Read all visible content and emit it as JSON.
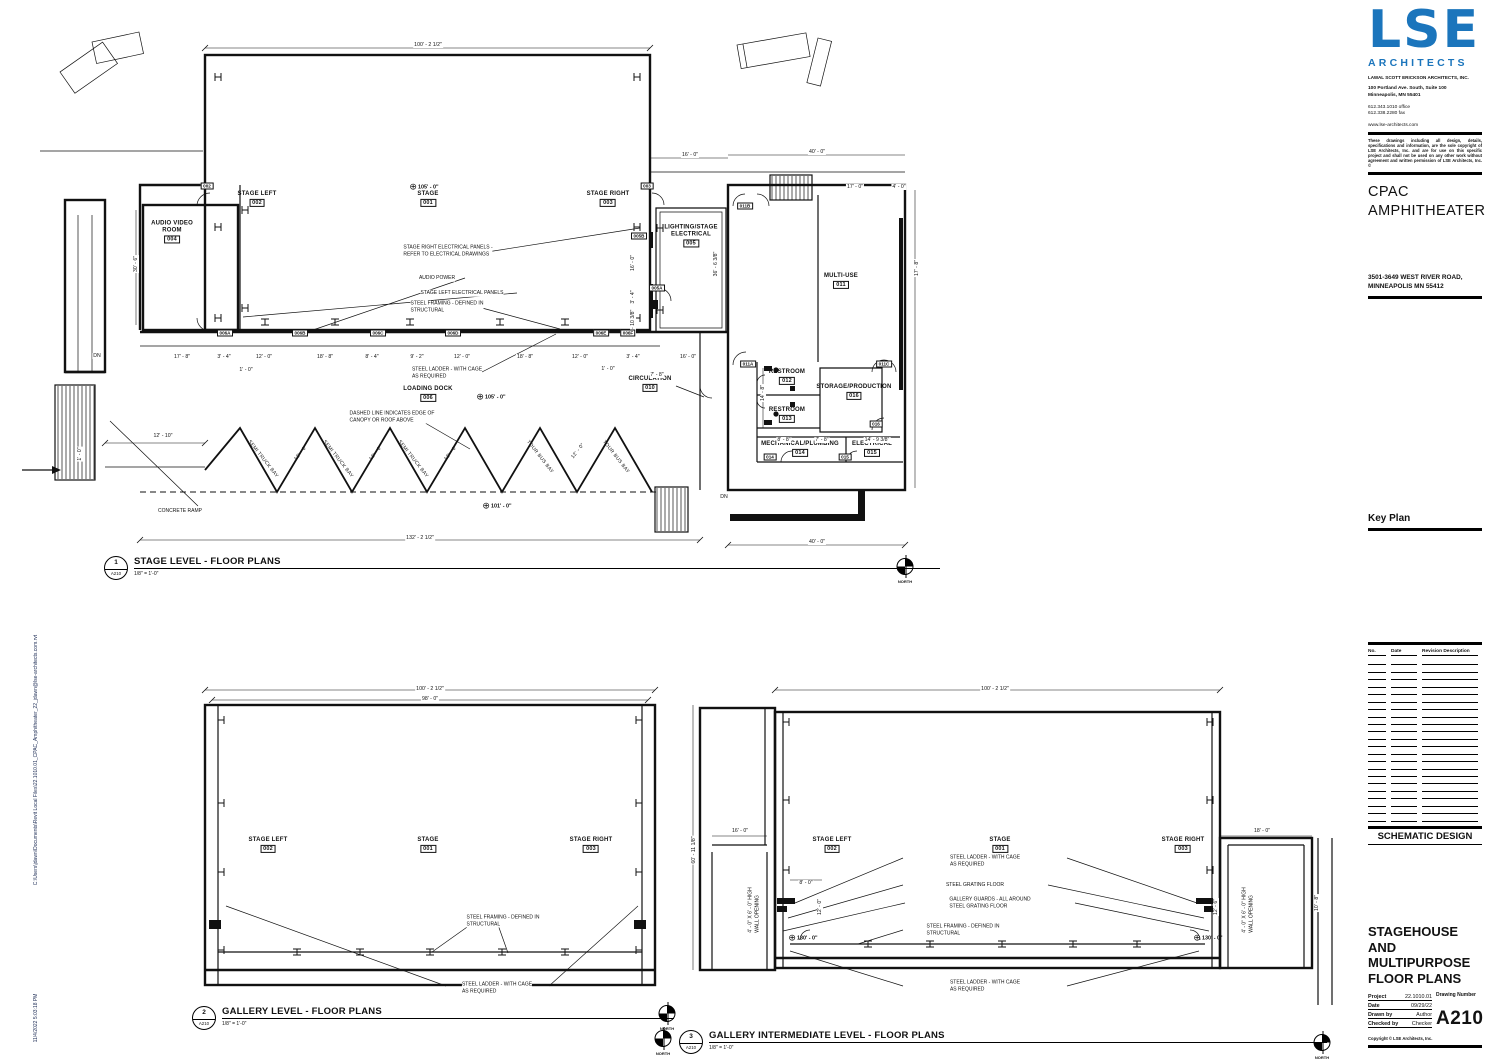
{
  "edge": {
    "path": "C:\\Users\\jdawn\\Documents\\Revit Local Files\\22.1010.01_CPAC_Amphitheater_22_jdawn@lse-architects.com.rvt",
    "timestamp": "11/4/2022 5:03:18 PM"
  },
  "titleblock": {
    "logo": "LSE",
    "logo_sub": "ARCHITECTS",
    "firm": "LAWAL SCOTT ERICKSON ARCHITECTS, INC.",
    "address1": "100 Portland Ave. South, Suite 100",
    "address2": "Minneapolis, MN 55401",
    "phone": "612.343.1010  office",
    "fax": "612.338.2280  fax",
    "website": "www.lse-architects.com",
    "disclaimer": "These drawings including all design, details, specifications and information, are the sole copyright of LSE Architects, Inc. and are for use on this specific project and shall not be used on any other work without agreement and written permission of LSE Architects, Inc. ©",
    "project_name_line1": "CPAC",
    "project_name_line2": "AMPHITHEATER",
    "project_address1": "3501-3649 WEST RIVER ROAD,",
    "project_address2": "MINNEAPOLIS MN 55412",
    "key_plan_label": "Key Plan",
    "stamp": "NOT FOR CONSTRUCTION",
    "revision_headers": [
      "No.",
      "Date",
      "Revision Description"
    ],
    "phase": "SCHEMATIC DESIGN",
    "sheet_title_line1": "STAGEHOUSE AND",
    "sheet_title_line2": "MULTIPURPOSE",
    "sheet_title_line3": "FLOOR PLANS",
    "project_label": "Project",
    "project_number": "22.1010.01",
    "date_label": "Date",
    "date": "09/29/22",
    "drawn_label": "Drawn by",
    "drawn": "Author",
    "checked_label": "Checked by",
    "checked": "Checker",
    "drawing_number_label": "Drawing Number",
    "drawing_number": "A210",
    "copyright": "Copyright © LSE Architects, Inc."
  },
  "plans": {
    "p1": {
      "num": "1",
      "sheet": "A210",
      "title": "STAGE LEVEL - FLOOR PLANS",
      "scale": "1/8\" = 1'-0\""
    },
    "p2": {
      "num": "2",
      "sheet": "A210",
      "title": "GALLERY LEVEL - FLOOR PLANS",
      "scale": "1/8\" = 1'-0\""
    },
    "p3": {
      "num": "3",
      "sheet": "A210",
      "title": "GALLERY INTERMEDIATE LEVEL - FLOOR PLANS",
      "scale": "1/8\" = 1'-0\""
    }
  },
  "annotations": [
    {
      "t": "room",
      "id": "room-stage-left",
      "name": "STAGE LEFT",
      "num": "002",
      "x": 257,
      "y": 199
    },
    {
      "t": "room",
      "id": "room-stage",
      "name": "STAGE",
      "num": "001",
      "x": 428,
      "y": 199
    },
    {
      "t": "room",
      "id": "room-stage-right",
      "name": "STAGE RIGHT",
      "num": "003",
      "x": 608,
      "y": 199
    },
    {
      "t": "room",
      "id": "room-audio-video",
      "name": "AUDIO VIDEO\nROOM",
      "num": "004",
      "x": 172,
      "y": 232
    },
    {
      "t": "room",
      "id": "room-lighting-stage-electrical",
      "name": "LIGHTING/STAGE\nELECTRICAL",
      "num": "005",
      "x": 691,
      "y": 236
    },
    {
      "t": "room",
      "id": "room-loading-dock",
      "name": "LOADING DOCK",
      "num": "006",
      "x": 428,
      "y": 394
    },
    {
      "t": "room",
      "id": "room-circulation",
      "name": "CIRCULATION",
      "num": "010",
      "x": 650,
      "y": 384
    },
    {
      "t": "room",
      "id": "room-multi-use",
      "name": "MULTI-USE",
      "num": "011",
      "x": 841,
      "y": 281
    },
    {
      "t": "room",
      "id": "room-restroom-012",
      "name": "RESTROOM",
      "num": "012",
      "x": 787,
      "y": 377
    },
    {
      "t": "room",
      "id": "room-restroom-013",
      "name": "RESTROOM",
      "num": "013",
      "x": 787,
      "y": 415
    },
    {
      "t": "room",
      "id": "room-mechanical-plumbing",
      "name": "MECHANICAL/PLUMBING",
      "num": "014",
      "x": 800,
      "y": 449
    },
    {
      "t": "room",
      "id": "room-electrical",
      "name": "ELECTRICAL",
      "num": "015",
      "x": 872,
      "y": 449
    },
    {
      "t": "room",
      "id": "room-storage-production",
      "name": "STORAGE/PRODUCTION",
      "num": "016",
      "x": 854,
      "y": 392
    },
    {
      "t": "room",
      "id": "p2-room-stage-left",
      "name": "STAGE LEFT",
      "num": "002",
      "x": 268,
      "y": 845
    },
    {
      "t": "room",
      "id": "p2-room-stage",
      "name": "STAGE",
      "num": "001",
      "x": 428,
      "y": 845
    },
    {
      "t": "room",
      "id": "p2-room-stage-right",
      "name": "STAGE RIGHT",
      "num": "003",
      "x": 591,
      "y": 845
    },
    {
      "t": "room",
      "id": "p3-room-stage-left",
      "name": "STAGE LEFT",
      "num": "002",
      "x": 832,
      "y": 845
    },
    {
      "t": "room",
      "id": "p3-room-stage",
      "name": "STAGE",
      "num": "001",
      "x": 1000,
      "y": 845
    },
    {
      "t": "room",
      "id": "p3-room-stage-right",
      "name": "STAGE RIGHT",
      "num": "003",
      "x": 1183,
      "y": 845
    },
    {
      "t": "note",
      "id": "note-stage-right-panels",
      "txt": "STAGE RIGHT ELECTRICAL PANELS -\nREFER TO ELECTRICAL DRAWINGS",
      "x": 448,
      "y": 251
    },
    {
      "t": "note",
      "id": "note-audio-power",
      "txt": "AUDIO POWER",
      "x": 437,
      "y": 278
    },
    {
      "t": "note",
      "id": "note-stage-left-panels",
      "txt": "STAGE LEFT ELECTRICAL PANELS",
      "x": 462,
      "y": 293
    },
    {
      "t": "note",
      "id": "note-steel-framing",
      "txt": "STEEL FRAMING - DEFINED IN\nSTRUCTURAL",
      "x": 447,
      "y": 307
    },
    {
      "t": "note",
      "id": "note-steel-ladder",
      "txt": "STEEL LADDER - WITH CAGE\nAS REQUIRED",
      "x": 447,
      "y": 373
    },
    {
      "t": "note",
      "id": "note-canopy-dashed",
      "txt": "DASHED LINE INDICATES EDGE OF\nCANOPY OR ROOF ABOVE",
      "x": 392,
      "y": 417
    },
    {
      "t": "note",
      "id": "note-concrete-ramp",
      "txt": "CONCRETE RAMP",
      "x": 180,
      "y": 511
    },
    {
      "t": "note",
      "id": "p2-note-steel-framing",
      "txt": "STEEL FRAMING - DEFINED IN\nSTRUCTURAL",
      "x": 503,
      "y": 921
    },
    {
      "t": "note",
      "id": "p2-note-steel-ladder",
      "txt": "STEEL LADDER - WITH CAGE\nAS REQUIRED",
      "x": 497,
      "y": 988
    },
    {
      "t": "note",
      "id": "p3-note-steel-ladder-top",
      "txt": "STEEL LADDER - WITH CAGE\nAS REQUIRED",
      "x": 985,
      "y": 861
    },
    {
      "t": "note",
      "id": "p3-note-steel-grating",
      "txt": "STEEL GRATING FLOOR",
      "x": 975,
      "y": 885
    },
    {
      "t": "note",
      "id": "p3-note-gallery-guards",
      "txt": "GALLERY GUARDS - ALL AROUND\nSTEEL GRATING FLOOR",
      "x": 990,
      "y": 903
    },
    {
      "t": "note",
      "id": "p3-note-steel-framing",
      "txt": "STEEL FRAMING - DEFINED IN\nSTRUCTURAL",
      "x": 963,
      "y": 930
    },
    {
      "t": "note",
      "id": "p3-note-steel-ladder-bottom",
      "txt": "STEEL LADDER - WITH CAGE\nAS REQUIRED",
      "x": 985,
      "y": 986
    },
    {
      "t": "note",
      "id": "p3-note-wall-opening-left",
      "txt": "4' - 0\" X 6' - 0\" HIGH\nWALL OPENING",
      "x": 754,
      "y": 910,
      "rot": -90
    },
    {
      "t": "note",
      "id": "p3-note-wall-opening-right",
      "txt": "4' - 0\" X 6' - 0\" HIGH\nWALL OPENING",
      "x": 1248,
      "y": 910,
      "rot": -90
    },
    {
      "t": "dim",
      "id": "dim-top-overall",
      "txt": "100' - 2 1/2\"",
      "x": 428,
      "y": 45
    },
    {
      "t": "dim",
      "id": "dim-16-0",
      "txt": "16' - 0\"",
      "x": 690,
      "y": 155
    },
    {
      "t": "dim",
      "id": "dim-40-0-top",
      "txt": "40' - 0\"",
      "x": 817,
      "y": 152
    },
    {
      "t": "dim",
      "id": "dim-17-0",
      "txt": "17' - 0\"",
      "x": 855,
      "y": 187
    },
    {
      "t": "dim",
      "id": "dim-4-0",
      "txt": "4' - 0\"",
      "x": 899,
      "y": 187
    },
    {
      "t": "dim",
      "txt": "17' - 8\"",
      "x": 182,
      "y": 357
    },
    {
      "t": "dim",
      "txt": "3' - 4\"",
      "x": 224,
      "y": 357
    },
    {
      "t": "dim",
      "txt": "12' - 0\"",
      "x": 264,
      "y": 357
    },
    {
      "t": "dim",
      "txt": "18' - 8\"",
      "x": 325,
      "y": 357
    },
    {
      "t": "dim",
      "txt": "8' - 4\"",
      "x": 372,
      "y": 357
    },
    {
      "t": "dim",
      "txt": "9' - 2\"",
      "x": 417,
      "y": 357
    },
    {
      "t": "dim",
      "txt": "12' - 0\"",
      "x": 462,
      "y": 357
    },
    {
      "t": "dim",
      "txt": "18' - 8\"",
      "x": 525,
      "y": 357
    },
    {
      "t": "dim",
      "txt": "12' - 0\"",
      "x": 580,
      "y": 357
    },
    {
      "t": "dim",
      "txt": "3' - 4\"",
      "x": 633,
      "y": 357
    },
    {
      "t": "dim",
      "txt": "16' - 0\"",
      "x": 688,
      "y": 357
    },
    {
      "t": "dim",
      "txt": "1' - 0\"",
      "x": 246,
      "y": 370
    },
    {
      "t": "dim",
      "txt": "1' - 0\"",
      "x": 608,
      "y": 369
    },
    {
      "t": "dim",
      "txt": "7' - 8\"",
      "x": 657,
      "y": 375
    },
    {
      "t": "dim",
      "txt": "12' - 10\"",
      "x": 163,
      "y": 436
    },
    {
      "t": "dim",
      "txt": "8' - 8\"",
      "x": 784,
      "y": 440
    },
    {
      "t": "dim",
      "txt": "7' - 8\"",
      "x": 822,
      "y": 440
    },
    {
      "t": "dim",
      "txt": "14' - 9 3/8\"",
      "x": 877,
      "y": 440
    },
    {
      "t": "dim",
      "id": "dim-bottom-overall",
      "txt": "132' - 2 1/2\"",
      "x": 420,
      "y": 538
    },
    {
      "t": "dim",
      "txt": "40' - 0\"",
      "x": 817,
      "y": 542
    },
    {
      "t": "dim",
      "txt": "30' - 6\"",
      "x": 136,
      "y": 264,
      "rot": -90
    },
    {
      "t": "dim",
      "txt": "36' - 6 3/8\"",
      "x": 716,
      "y": 264,
      "rot": -90
    },
    {
      "t": "dim",
      "txt": "14' - 8\"",
      "x": 763,
      "y": 393,
      "rot": -90
    },
    {
      "t": "dim",
      "txt": "16' - 0\"",
      "x": 633,
      "y": 263,
      "rot": -90
    },
    {
      "t": "dim",
      "txt": "3' - 4\"",
      "x": 633,
      "y": 297,
      "rot": -90
    },
    {
      "t": "dim",
      "txt": "7' - 10 3/8\"",
      "x": 633,
      "y": 322,
      "rot": -90
    },
    {
      "t": "dim",
      "txt": "17' - 8\"",
      "x": 917,
      "y": 268,
      "rot": -90
    },
    {
      "t": "dim",
      "txt": "1' - 0\"",
      "x": 80,
      "y": 454,
      "rot": -90
    },
    {
      "t": "dim",
      "txt": "DN",
      "x": 97,
      "y": 356
    },
    {
      "t": "dim",
      "txt": "DN",
      "x": 724,
      "y": 497
    },
    {
      "t": "dim",
      "id": "p2-dim-overall",
      "txt": "100' - 2 1/2\"",
      "x": 430,
      "y": 689
    },
    {
      "t": "dim",
      "id": "p2-dim-98",
      "txt": "98' - 0\"",
      "x": 430,
      "y": 699
    },
    {
      "t": "dim",
      "id": "p3-dim-overall",
      "txt": "100' - 2 1/2\"",
      "x": 995,
      "y": 689
    },
    {
      "t": "dim",
      "txt": "16' - 0\"",
      "x": 740,
      "y": 831
    },
    {
      "t": "dim",
      "txt": "18' - 0\"",
      "x": 1262,
      "y": 831
    },
    {
      "t": "dim",
      "txt": "8' - 0\"",
      "x": 806,
      "y": 883
    },
    {
      "t": "dim",
      "txt": "60' - 11 1/8\"",
      "x": 694,
      "y": 850,
      "rot": -90
    },
    {
      "t": "dim",
      "txt": "12' - 0\"",
      "x": 820,
      "y": 907,
      "rot": -90
    },
    {
      "t": "dim",
      "txt": "12' - 6\"",
      "x": 1216,
      "y": 907,
      "rot": -90
    },
    {
      "t": "dim",
      "txt": "10' - 8\"",
      "x": 1317,
      "y": 903,
      "rot": -90
    },
    {
      "t": "elev",
      "id": "elev-stage-105",
      "txt": "105' - 0\"",
      "x": 424,
      "y": 187
    },
    {
      "t": "elev",
      "id": "elev-dock-105",
      "txt": "105' - 0\"",
      "x": 491,
      "y": 397
    },
    {
      "t": "elev",
      "id": "elev-dock-101",
      "txt": "101' - 0\"",
      "x": 497,
      "y": 506
    },
    {
      "t": "elev",
      "id": "p3-elev-130-left",
      "txt": "130' - 0\"",
      "x": 803,
      "y": 938
    },
    {
      "t": "elev",
      "id": "p3-elev-130-right",
      "txt": "130' - 0\"",
      "x": 1208,
      "y": 938
    },
    {
      "t": "bay",
      "txt": "SEMI TRUCK BAY",
      "x": 263,
      "y": 459,
      "rot": 52
    },
    {
      "t": "bay",
      "txt": "SEMI TRUCK BAY",
      "x": 338,
      "y": 459,
      "rot": 52
    },
    {
      "t": "bay",
      "txt": "SEMI TRUCK BAY",
      "x": 413,
      "y": 459,
      "rot": 52
    },
    {
      "t": "bay",
      "txt": "TOUR BUS BAY",
      "x": 540,
      "y": 457,
      "rot": 52
    },
    {
      "t": "bay",
      "txt": "TOUR BUS BAY",
      "x": 616,
      "y": 457,
      "rot": 52
    },
    {
      "t": "bay",
      "txt": "12' - 0\"",
      "x": 301,
      "y": 453,
      "rot": -52
    },
    {
      "t": "bay",
      "txt": "12' - 0\"",
      "x": 376,
      "y": 453,
      "rot": -52
    },
    {
      "t": "bay",
      "txt": "12' - 0\"",
      "x": 451,
      "y": 453,
      "rot": -52
    },
    {
      "t": "bay",
      "txt": "12' - 0\"",
      "x": 578,
      "y": 451,
      "rot": -52
    },
    {
      "t": "tag",
      "txt": "006A",
      "x": 225,
      "y": 333
    },
    {
      "t": "tag",
      "txt": "006B",
      "x": 300,
      "y": 333
    },
    {
      "t": "tag",
      "txt": "006C",
      "x": 378,
      "y": 333
    },
    {
      "t": "tag",
      "txt": "006D",
      "x": 453,
      "y": 333
    },
    {
      "t": "tag",
      "txt": "006E",
      "x": 601,
      "y": 333
    },
    {
      "t": "tag",
      "txt": "006F",
      "x": 628,
      "y": 333
    },
    {
      "t": "tag",
      "txt": "002",
      "x": 207,
      "y": 186
    },
    {
      "t": "tag",
      "txt": "003",
      "x": 647,
      "y": 186
    },
    {
      "t": "tag",
      "txt": "005B",
      "x": 639,
      "y": 236
    },
    {
      "t": "tag",
      "txt": "005A",
      "x": 657,
      "y": 288
    },
    {
      "t": "tag",
      "txt": "011B",
      "x": 745,
      "y": 206
    },
    {
      "t": "tag",
      "txt": "011A",
      "x": 748,
      "y": 364
    },
    {
      "t": "tag",
      "txt": "011C",
      "x": 884,
      "y": 364
    },
    {
      "t": "tag",
      "txt": "016",
      "x": 876,
      "y": 424
    },
    {
      "t": "tag",
      "txt": "014",
      "x": 770,
      "y": 457
    },
    {
      "t": "tag",
      "txt": "015",
      "x": 845,
      "y": 457
    },
    {
      "t": "north",
      "id": "p1-north",
      "txt": "NORTH",
      "x": 905,
      "y": 571
    },
    {
      "t": "north",
      "id": "p2-north",
      "txt": "NORTH",
      "x": 667,
      "y": 1018
    },
    {
      "t": "north",
      "id": "p3-north-left",
      "txt": "NORTH",
      "x": 663,
      "y": 1043
    },
    {
      "t": "north",
      "id": "p3-north-right",
      "txt": "NORTH",
      "x": 1322,
      "y": 1047
    }
  ]
}
